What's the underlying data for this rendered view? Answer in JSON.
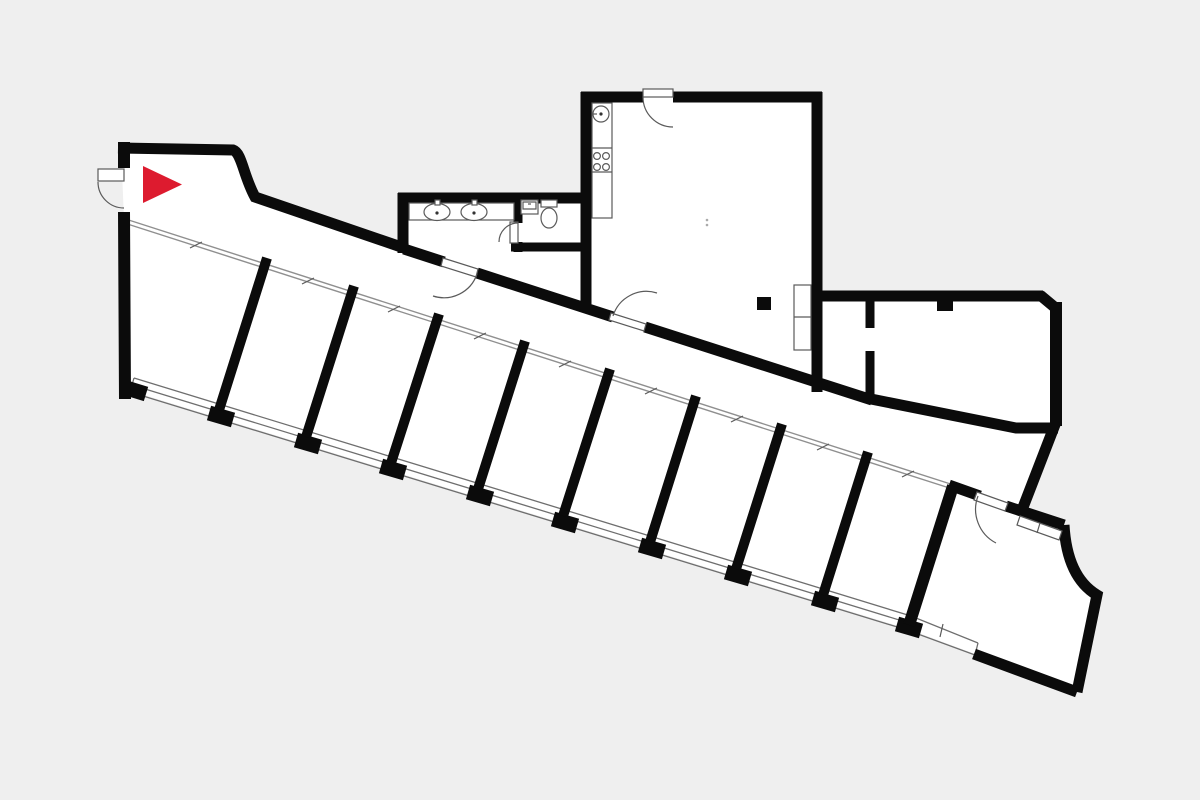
{
  "page": {
    "type": "floor-plan-viewer",
    "title": "Floor plan"
  },
  "colors": {
    "bg": "#efefef",
    "floor": "#ffffff",
    "wall": "#0b0b0b",
    "line": "#5a5a5a",
    "glass": "#8f8f8f",
    "window": "#6e6e6e",
    "marker": "#dd1b2f"
  },
  "marker": {
    "name": "position-marker",
    "shape": "triangle-right",
    "color": "#dd1b2f"
  },
  "plan": {
    "room_row_count": 9,
    "partition_count": 8,
    "glass_front_tick_count": 9,
    "door_count": 6,
    "window_band_segments": 10,
    "fixtures": [
      "kitchen-counter",
      "kitchen-sink",
      "stove-burners",
      "wardrobe",
      "column",
      "column",
      "bathroom-counter",
      "washbasin",
      "washbasin",
      "wc-basin",
      "toilet",
      "window-pane",
      "window-pane"
    ]
  }
}
